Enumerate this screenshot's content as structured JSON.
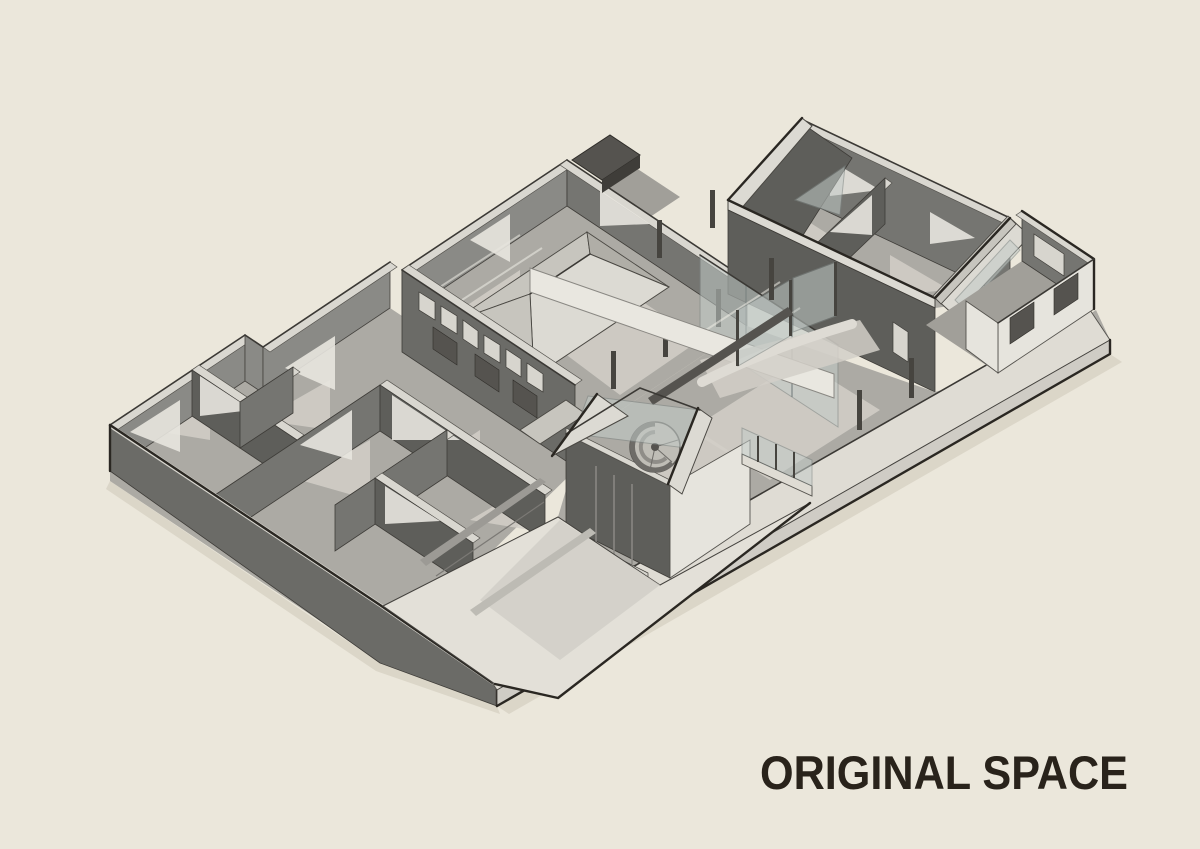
{
  "title": {
    "text": "ORIGINAL SPACE"
  },
  "palette": {
    "bg": "#EBE7DB",
    "ink": "#29231B",
    "outline": "#2A2722",
    "wallDark": "#5E5E5A",
    "wall": "#6B6B67",
    "wallMid": "#757571",
    "wallLight": "#8A8A86",
    "cap": "#D9D7D0",
    "floor": "#ACAAA4",
    "floorLight": "#D2CFC8",
    "roofLight": "#DCDAD3",
    "roofMid": "#C7C5BE",
    "light": "#E6E4DD",
    "plinth": "#DFDCD4",
    "ramp": "#E3E0D8",
    "glass": "#C3CBC8",
    "opening": "#55534F"
  }
}
